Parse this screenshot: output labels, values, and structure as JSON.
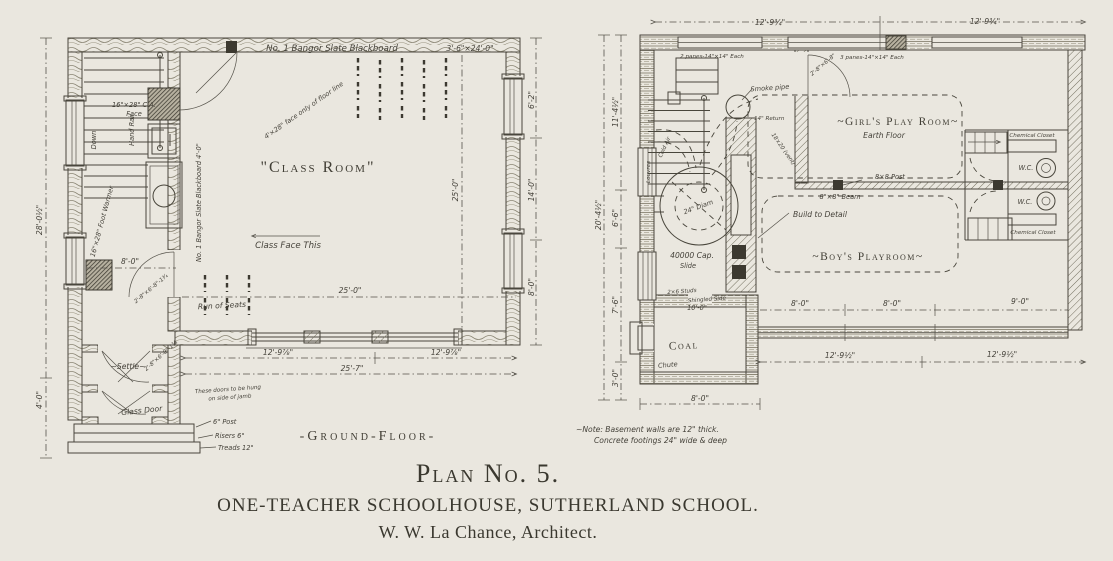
{
  "caption": {
    "plan_no": "Plan No. 5.",
    "title": "ONE-TEACHER SCHOOLHOUSE, SUTHERLAND SCHOOL.",
    "architect": "W. W. La Chance, Architect."
  },
  "ground_floor": {
    "plan_title": "-Ground-Floor-",
    "room_label": "\"Class Room\"",
    "annotations": {
      "blackboard_top": "No. 1 Bangor Slate Blackboard",
      "blackboard_top_size": "3'-6\"×24'-0\"",
      "blackboard_side": "No. 1 Bangor Slate Blackboard 4'-0\"",
      "face_note": "4'×28\" face only of floor line",
      "class_face": "Class Face This",
      "run_of_seats": "Run of Seats",
      "ca_face_1": "16\"×28\" C.A.",
      "ca_face_2": "Face",
      "foot_warmer": "16\"×28\" Foot Warmer",
      "hand_rail": "Hand Rail",
      "down": "Down",
      "settle": "~Settle~",
      "glass_door": "Glass Door",
      "door_size": "2'-8\"×6'-8\"-1¾",
      "doors_note_1": "These doors to be hung",
      "doors_note_2": "on side of jamb",
      "post": "6\" Post",
      "risers": "Risers 6\"",
      "treads": "Treads 12\""
    },
    "dimensions": {
      "hall_width": "8'-0\"",
      "room_width": "25'-0\"",
      "room_depth": "25'-0\"",
      "bay_left": "12'-9⅞\"",
      "bay_right": "12'-9⅞\"",
      "overall_width": "25'-7\"",
      "side_total": "28'-0½\"",
      "porch_depth": "4'-0\"",
      "east_1": "6'-2\"",
      "east_2": "14'-0\"",
      "east_3": "8'-0\""
    }
  },
  "basement": {
    "rooms": {
      "girls": "~Girl's Play Room~",
      "girls_floor": "Earth Floor",
      "boys": "~Boy's Playroom~",
      "coal": "Coal"
    },
    "annotations": {
      "panes_2": "2 panes-14\"×14\" Each",
      "panes_3": "3 panes-14\"×14\" Each",
      "door_size": "2'-8\"×6'-8\"",
      "smoke_pipe": "Smoke pipe",
      "return_14": "14\" Return",
      "vent": "18×20 (vent)",
      "cold_air": "Cold Air",
      "louvres": "Louvres",
      "furnace_diam": "24\" Diam",
      "furnace_cap": "40000 Cap.",
      "slide": "Slide",
      "post": "8×8 Post",
      "beam": "8\"×8\" Beam",
      "build_to_detail": "Build to Detail",
      "wc_1": "W.C.",
      "wc_2": "W.C.",
      "chemical_closet_1": "Chemical Closet",
      "chemical_closet_2": "Chemical Closet",
      "chute": "Chute",
      "studs": "2×6 Studs",
      "shingled": "Shingled Side",
      "studs_height": "10'-0\"",
      "note_1": "~Note: Basement walls are 12\" thick.",
      "note_2": "Concrete footings 24\" wide & deep"
    },
    "dimensions": {
      "top_left": "12'-9¾\"",
      "top_right": "12'-9¾\"",
      "west_total": "20'-4½\"",
      "west_1": "11'-4½\"",
      "west_2": "6'-6\"",
      "west_3": "7'-6\"",
      "west_4": "3'-0\"",
      "int_1": "8'-0\"",
      "int_2": "8'-0\"",
      "int_3": "9'-0\"",
      "bot_left": "12'-9½\"",
      "bot_right": "12'-9½\"",
      "coal_width": "8'-0\""
    }
  }
}
